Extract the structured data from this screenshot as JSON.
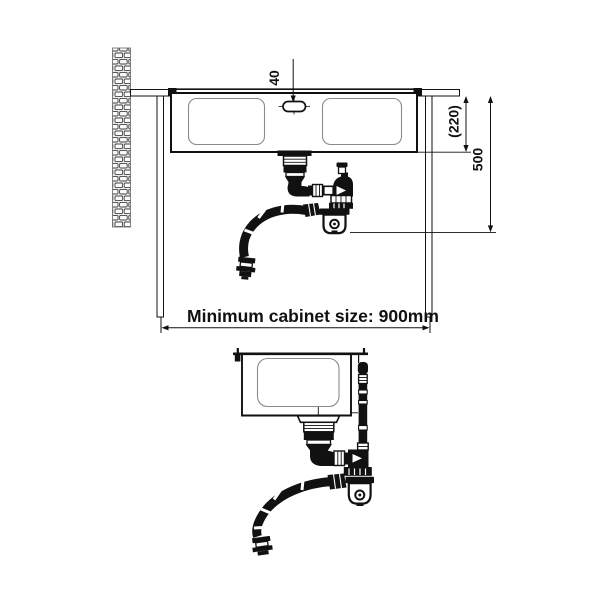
{
  "diagram": {
    "kind": "kitchen sink installation drawing",
    "labels": {
      "faucet_hole_offset": "40",
      "bowl_depth": "(220)",
      "installation_depth": "500",
      "cabinet_size": "Minimum cabinet size: 900mm"
    },
    "colors": {
      "ink": "#111111",
      "bowl_outline": "#8a8a8a",
      "wall_fill": "#ededed",
      "background": "#ffffff"
    }
  }
}
